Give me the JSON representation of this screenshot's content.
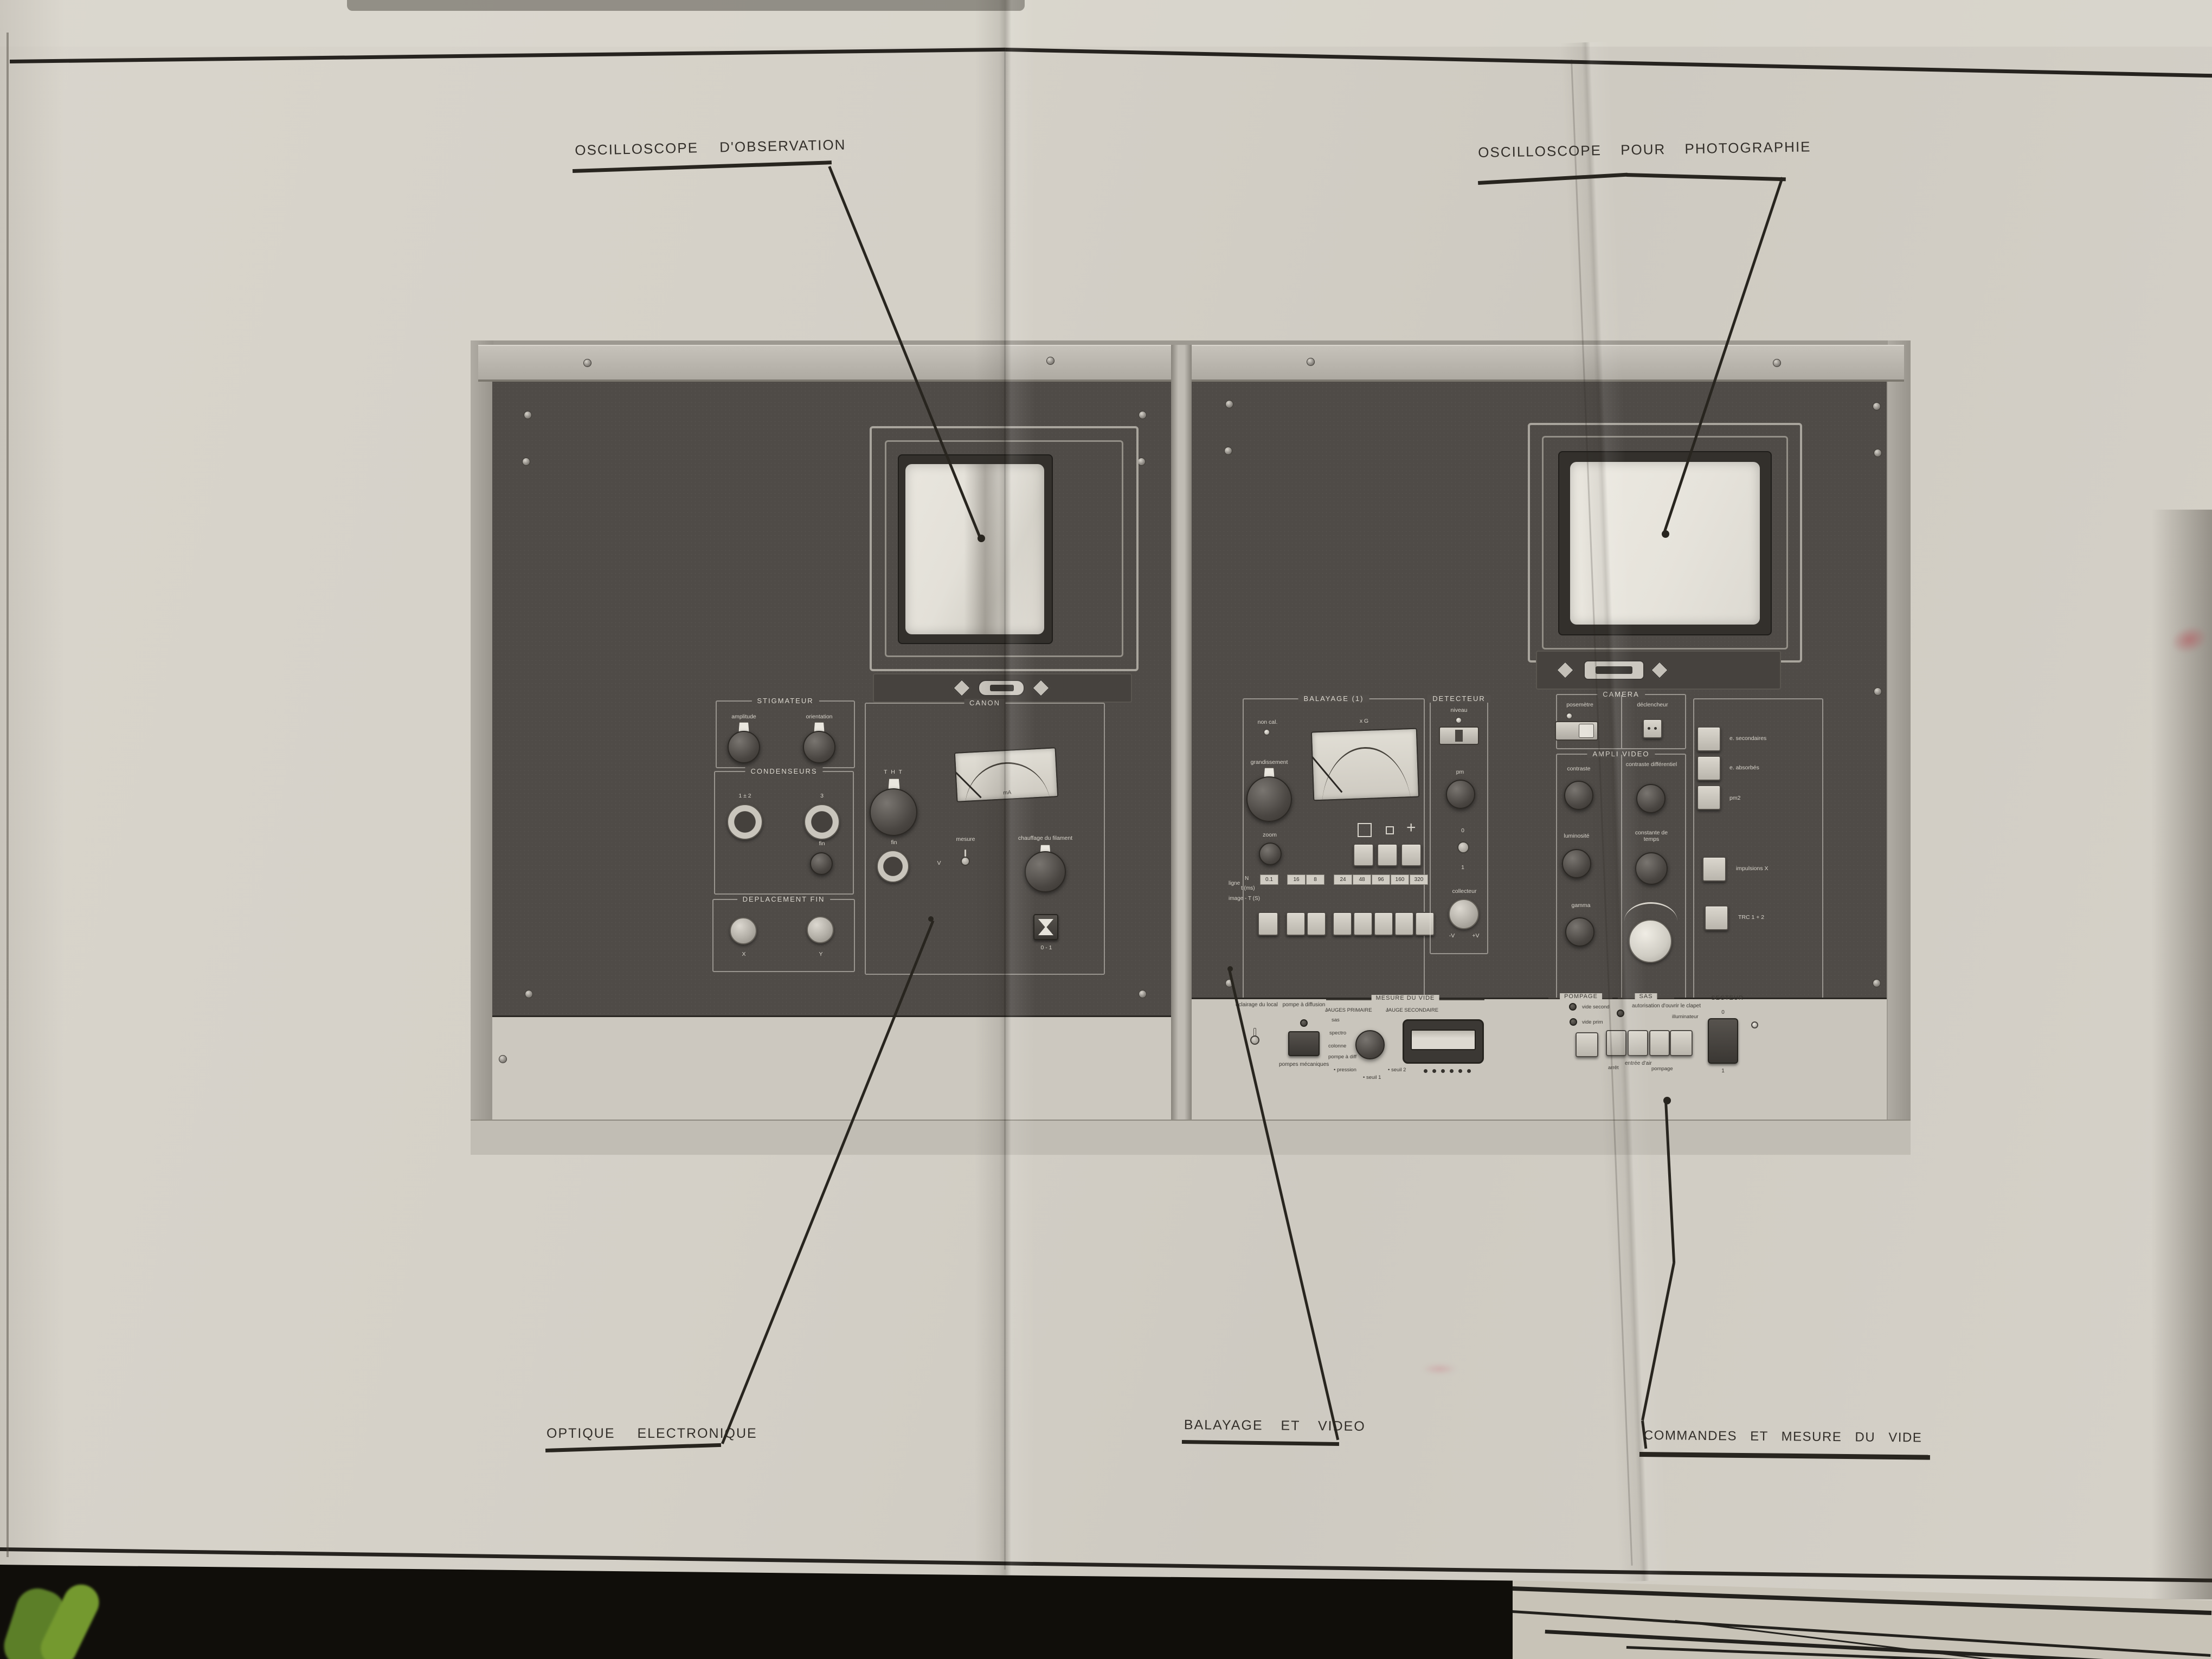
{
  "annotations": {
    "osc_observation": "OSCILLOSCOPE D'OBSERVATION",
    "osc_photographie": "OSCILLOSCOPE POUR PHOTOGRAPHIE",
    "optique_electronique": "OPTIQUE ELECTRONIQUE",
    "balayage_et_video": "BALAYAGE ET VIDEO",
    "commandes_mesure_vide": "COMMANDES ET MESURE DU VIDE"
  },
  "icons": {
    "ring": "○",
    "crosshair": "+"
  },
  "left_rack": {
    "stigmateur": {
      "title": "STIGMATEUR",
      "amplitude": "amplitude",
      "orientation": "orientation"
    },
    "condenseurs": {
      "title": "CONDENSEURS",
      "k12": "1 ± 2",
      "k3": "3",
      "fin": "fin"
    },
    "deplacement": {
      "title": "DEPLACEMENT FIN",
      "x": "X",
      "y": "Y"
    },
    "canon": {
      "title": "CANON",
      "tht": "T H T",
      "fin": "fin",
      "mesure": "mesure",
      "v": "V",
      "meter_unit": "mA",
      "chauffage": "chauffage du filament",
      "rocker": "0 - 1"
    }
  },
  "right_rack": {
    "balayage": {
      "title": "BALAYAGE (1)",
      "non_cal": "non cal.",
      "grandissement": "grandissement",
      "meter_label": "x G",
      "zoom": "zoom",
      "ligne": "ligne",
      "n": "N",
      "tms": "t (ms)",
      "image": "image - T (S)",
      "matrix": [
        [
          "100",
          "1",
          "0.1"
        ],
        [
          "800",
          "2",
          "16"
        ],
        [
          "400",
          "20",
          "8"
        ],
        [
          "1200",
          "20",
          "24"
        ],
        [
          "1200",
          "40",
          "48"
        ],
        [
          "1200",
          "80",
          "96"
        ],
        [
          "800",
          "200",
          "160"
        ],
        [
          "800",
          "400",
          "320"
        ]
      ]
    },
    "detecteur": {
      "title": "DETECTEUR",
      "niveau": "niveau",
      "pm": "pm",
      "zero": "0",
      "one": "1",
      "collecteur": "collecteur",
      "minus_v": "-V",
      "plus_v": "+V"
    },
    "camera": {
      "title": "CAMERA",
      "posemetre": "posemètre",
      "declencheur": "déclencheur"
    },
    "ampli": {
      "title": "AMPLI VIDEO",
      "contraste": "contraste",
      "contraste_diff": "contraste différentiel",
      "luminosite": "luminosité",
      "constante": "constante de temps",
      "gamma": "gamma"
    },
    "side_buttons": [
      "e. secondaires",
      "e. absorbés",
      "pm2",
      "impulsions X",
      "TRC 1 + 2"
    ],
    "bottom": {
      "eclairage": "éclairage du local",
      "pompe_diffusion": "pompe à diffusion",
      "pompes_mecaniques": "pompes mécaniques",
      "mesure_du_vide": "MESURE DU VIDE",
      "jauges_primaire": "JAUGES PRIMAIRE",
      "jauge_secondaire": "JAUGE SECONDAIRE",
      "sel_sas": "sas",
      "sel_spectro": "spectro",
      "sel_colonne": "colonne",
      "sel_pompe_diff": "pompe à diff",
      "pression": "• pression",
      "seuil1": "• seuil 1",
      "seuil2": "• seuil 2",
      "pompage_title": "POMPAGE",
      "vide_second": "vide second",
      "vide_prim": "vide prim",
      "sas_title": "SAS",
      "autorisation": "autorisation d'ouvrir le clapet",
      "arret": "arrêt",
      "entree_air": "entrée d'air",
      "pompage": "pompage",
      "illuminateur": "illuminateur",
      "secteur_title": "SECTEUR",
      "secteur_zero": "0",
      "secteur_one": "1"
    }
  },
  "colors": {
    "sheet": "#d3cfc6",
    "panel_dark": "#504c48",
    "panel_light": "#c9c5bc",
    "ink": "#28251f",
    "leaf_green": "#6f9432",
    "smudge_red": "#b04a52"
  }
}
